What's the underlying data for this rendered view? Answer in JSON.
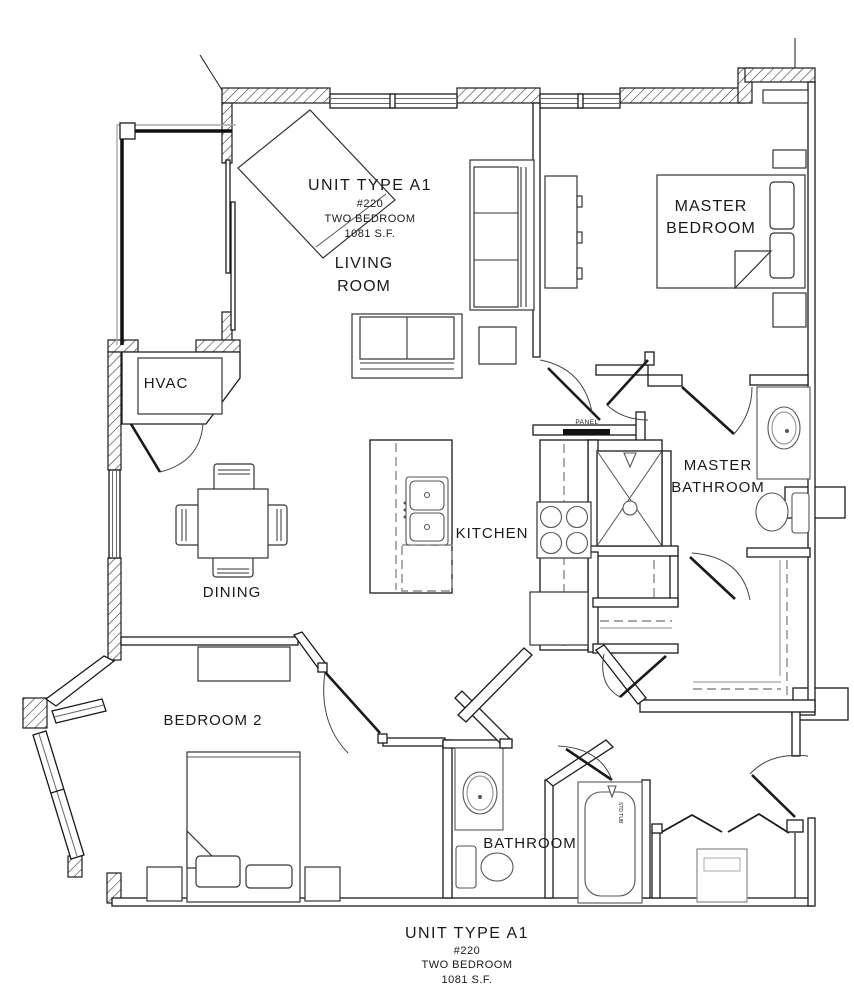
{
  "floor_plan": {
    "unit_title": {
      "name": "UNIT TYPE A1",
      "number": "#220",
      "type": "TWO BEDROOM",
      "area": "1081 S.F."
    },
    "rooms": {
      "living_1": "LIVING",
      "living_2": "ROOM",
      "master_bedroom_1": "MASTER",
      "master_bedroom_2": "BEDROOM",
      "master_bathroom_1": "MASTER",
      "master_bathroom_2": "BATHROOM",
      "kitchen": "KITCHEN",
      "dining": "DINING",
      "bedroom2": "BEDROOM 2",
      "bathroom": "BATHROOM",
      "hvac": "HVAC"
    },
    "annotations": {
      "panel": "PANEL",
      "tub": "STD TUB"
    },
    "colors": {
      "ink": "#1a1a1a",
      "paper": "#ffffff"
    }
  }
}
